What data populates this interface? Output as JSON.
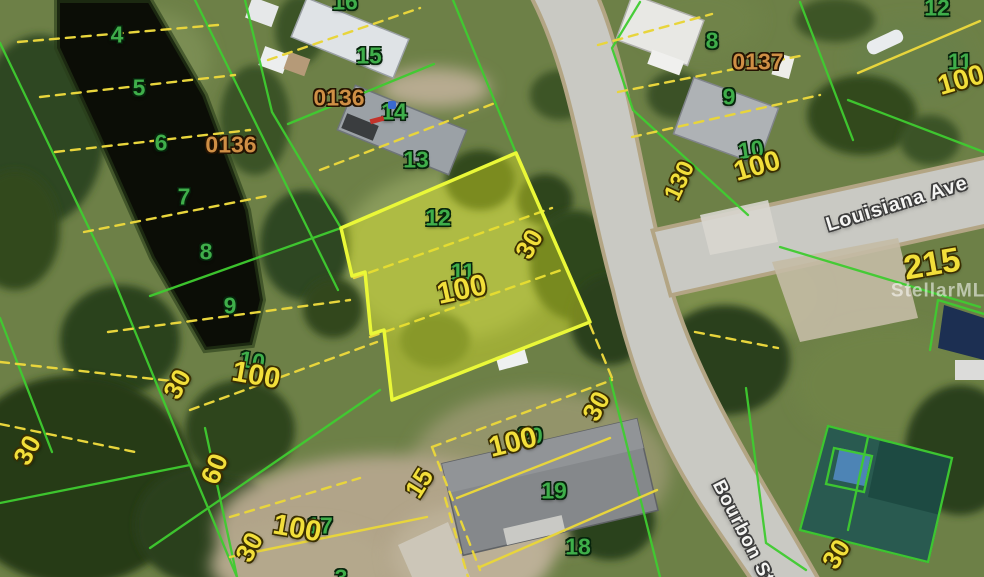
{
  "image": {
    "kind": "aerial-parcel-map",
    "width": 984,
    "height": 577
  },
  "watermark": {
    "text": "StellarMLS",
    "x": 945,
    "y": 291,
    "size": 19
  },
  "streets": [
    {
      "name": "Louisiana Ave",
      "x": 897,
      "y": 204,
      "rot": -17,
      "size": 20
    },
    {
      "name": "Bourbon St",
      "x": 743,
      "y": 532,
      "rot": 63,
      "size": 19
    }
  ],
  "plat_numbers": [
    {
      "text": "0136",
      "x": 231,
      "y": 145,
      "size": 23
    },
    {
      "text": "0136",
      "x": 339,
      "y": 98,
      "size": 23
    },
    {
      "text": "0137",
      "x": 758,
      "y": 62,
      "size": 23
    }
  ],
  "lot_numbers": [
    {
      "text": "4",
      "x": 117,
      "y": 35
    },
    {
      "text": "5",
      "x": 139,
      "y": 88
    },
    {
      "text": "6",
      "x": 161,
      "y": 143
    },
    {
      "text": "7",
      "x": 184,
      "y": 197
    },
    {
      "text": "8",
      "x": 206,
      "y": 252
    },
    {
      "text": "9",
      "x": 230,
      "y": 306
    },
    {
      "text": "10",
      "x": 252,
      "y": 361,
      "rot": 10
    },
    {
      "text": "16",
      "x": 345,
      "y": 2
    },
    {
      "text": "15",
      "x": 369,
      "y": 56
    },
    {
      "text": "14",
      "x": 394,
      "y": 112
    },
    {
      "text": "13",
      "x": 416,
      "y": 160
    },
    {
      "text": "12",
      "x": 438,
      "y": 218
    },
    {
      "text": "11",
      "x": 463,
      "y": 272
    },
    {
      "text": "8",
      "x": 712,
      "y": 41
    },
    {
      "text": "9",
      "x": 729,
      "y": 97
    },
    {
      "text": "10",
      "x": 751,
      "y": 150,
      "rot": -8
    },
    {
      "text": "12",
      "x": 937,
      "y": 8
    },
    {
      "text": "11",
      "x": 960,
      "y": 62
    },
    {
      "text": "20",
      "x": 530,
      "y": 436
    },
    {
      "text": "19",
      "x": 554,
      "y": 491
    },
    {
      "text": "18",
      "x": 578,
      "y": 547
    },
    {
      "text": "17",
      "x": 320,
      "y": 526
    },
    {
      "text": "3",
      "x": 341,
      "y": 578
    }
  ],
  "dimensions": [
    {
      "text": "100",
      "x": 256,
      "y": 376,
      "rot": 10,
      "size": 29
    },
    {
      "text": "30",
      "x": 177,
      "y": 384,
      "rot": -62,
      "size": 26
    },
    {
      "text": "30",
      "x": 27,
      "y": 450,
      "rot": -62,
      "size": 26
    },
    {
      "text": "60",
      "x": 215,
      "y": 469,
      "rot": -68,
      "size": 27
    },
    {
      "text": "30",
      "x": 249,
      "y": 547,
      "rot": -62,
      "size": 26
    },
    {
      "text": "100",
      "x": 297,
      "y": 529,
      "rot": 10,
      "size": 29
    },
    {
      "text": "15",
      "x": 419,
      "y": 483,
      "rot": -58,
      "size": 26
    },
    {
      "text": "100",
      "x": 513,
      "y": 443,
      "rot": -14,
      "size": 29
    },
    {
      "text": "30",
      "x": 596,
      "y": 406,
      "rot": -62,
      "size": 26
    },
    {
      "text": "30",
      "x": 529,
      "y": 244,
      "rot": -60,
      "size": 26
    },
    {
      "text": "100",
      "x": 462,
      "y": 290,
      "rot": -12,
      "size": 30
    },
    {
      "text": "100",
      "x": 757,
      "y": 166,
      "rot": -16,
      "size": 28
    },
    {
      "text": "130",
      "x": 680,
      "y": 181,
      "rot": -65,
      "size": 24
    },
    {
      "text": "100",
      "x": 961,
      "y": 80,
      "rot": -16,
      "size": 28
    },
    {
      "text": "215",
      "x": 932,
      "y": 264,
      "rot": -10,
      "size": 34
    },
    {
      "text": "30",
      "x": 836,
      "y": 554,
      "rot": -58,
      "size": 26
    }
  ],
  "markers": [
    {
      "kind": "red-tick",
      "x": 377,
      "y": 120,
      "rot": -15,
      "color": "#c3332b"
    },
    {
      "kind": "blue-dot",
      "x": 392,
      "y": 105,
      "color": "#3a6ad1"
    }
  ],
  "colors": {
    "parcel_green": "#3fcc30",
    "lot_line_yellow": "#e8d53c",
    "highlight_stroke": "#eaf838",
    "highlight_fill": "rgba(225,230,35,0.42)",
    "lot_number_green": "#3fae4a",
    "dim_yellow": "#f2df3a",
    "plat_orange": "#cf8f45",
    "street_white": "#f5f5f3",
    "water_dark": "#0b0d06",
    "road_gray": "#c9c9c3"
  }
}
